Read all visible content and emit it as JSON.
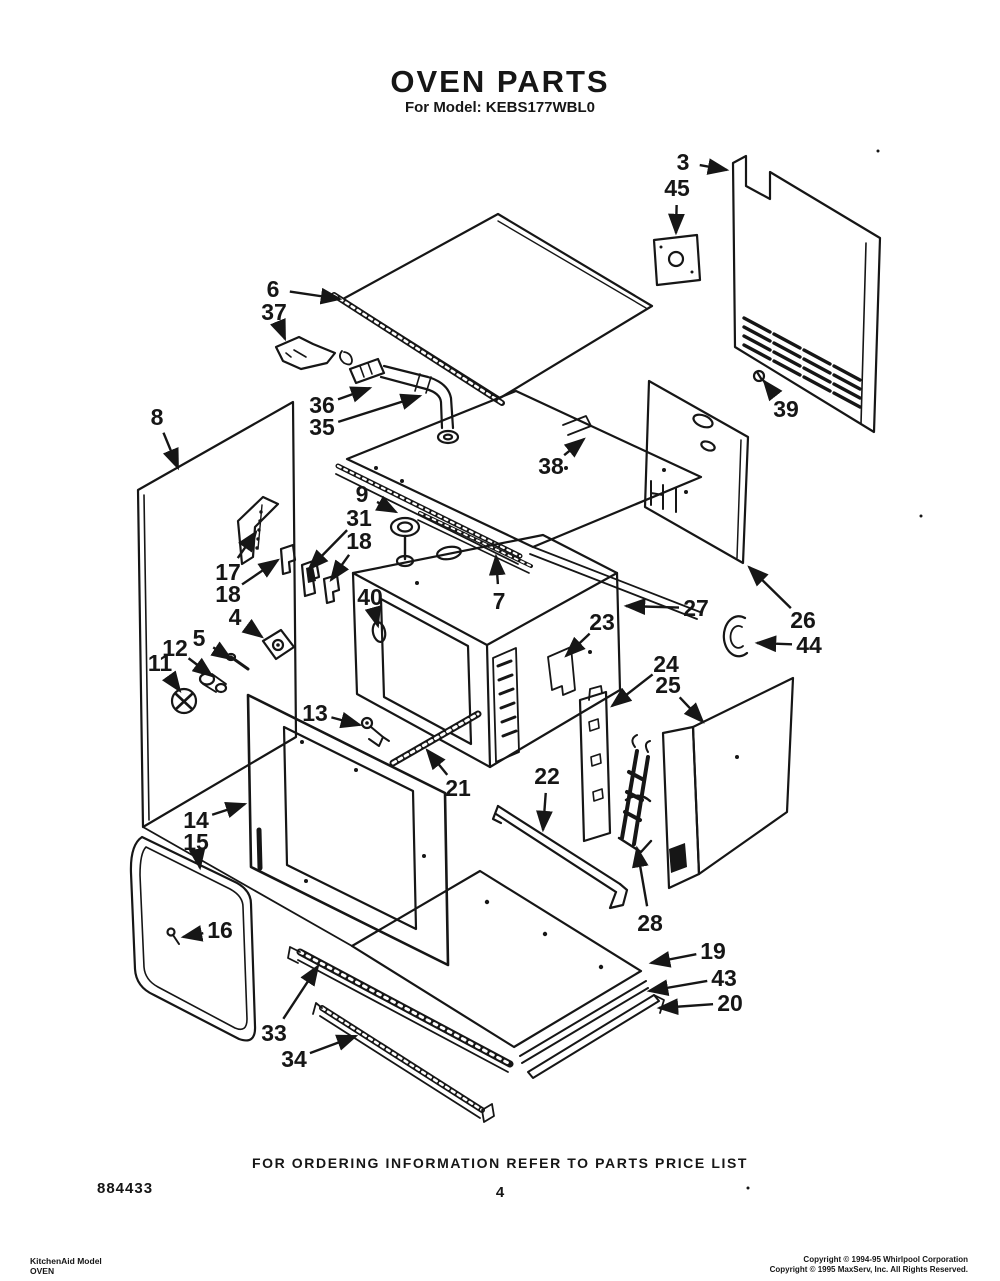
{
  "page": {
    "title": "OVEN PARTS",
    "subtitle": "For Model: KEBS177WBL0",
    "footer": {
      "ordering_note": "FOR ORDERING INFORMATION REFER TO PARTS PRICE LIST",
      "page_number": "4",
      "document_number": "884433",
      "corner_left_line1": "KitchenAid Model",
      "corner_left_line2": "OVEN",
      "copyright_line1": "Copyright © 1994-95 Whirlpool Corporation",
      "copyright_line2": "Copyright © 1995 MaxServ, Inc.  All Rights Reserved."
    }
  },
  "diagram": {
    "kind": "exploded-parts-diagram",
    "ink_color": "#161616",
    "paper_color": "#ffffff",
    "callouts": [
      {
        "num": "3",
        "lx": 683,
        "ly": 162,
        "ax": 727,
        "ay": 170
      },
      {
        "num": "45",
        "lx": 677,
        "ly": 188,
        "ax": 676,
        "ay": 233
      },
      {
        "num": "39",
        "lx": 786,
        "ly": 409,
        "ax": 764,
        "ay": 381
      },
      {
        "num": "6",
        "lx": 273,
        "ly": 289,
        "ax": 340,
        "ay": 299
      },
      {
        "num": "37",
        "lx": 274,
        "ly": 312,
        "ax": 285,
        "ay": 339
      },
      {
        "num": "36",
        "lx": 322,
        "ly": 405,
        "ax": 370,
        "ay": 388
      },
      {
        "num": "35",
        "lx": 322,
        "ly": 427,
        "ax": 420,
        "ay": 396
      },
      {
        "num": "8",
        "lx": 157,
        "ly": 417,
        "ax": 178,
        "ay": 468
      },
      {
        "num": "9",
        "lx": 362,
        "ly": 494,
        "ax": 396,
        "ay": 512
      },
      {
        "num": "31",
        "lx": 359,
        "ly": 518,
        "ax": 309,
        "ay": 569
      },
      {
        "num": "18",
        "lx": 359,
        "ly": 541,
        "ax": 331,
        "ay": 580
      },
      {
        "num": "17",
        "lx": 228,
        "ly": 572,
        "ax": 256,
        "ay": 532
      },
      {
        "num": "18",
        "lx": 228,
        "ly": 594,
        "ax": 278,
        "ay": 560
      },
      {
        "num": "40",
        "lx": 370,
        "ly": 597,
        "ax": 378,
        "ay": 626
      },
      {
        "num": "4",
        "lx": 235,
        "ly": 617,
        "ax": 262,
        "ay": 637
      },
      {
        "num": "5",
        "lx": 199,
        "ly": 638,
        "ax": 231,
        "ay": 659
      },
      {
        "num": "12",
        "lx": 175,
        "ly": 648,
        "ax": 212,
        "ay": 676
      },
      {
        "num": "11",
        "lx": 160,
        "ly": 663,
        "ax": 180,
        "ay": 691
      },
      {
        "num": "38",
        "lx": 551,
        "ly": 466,
        "ax": 584,
        "ay": 439
      },
      {
        "num": "7",
        "lx": 499,
        "ly": 601,
        "ax": 496,
        "ay": 556
      },
      {
        "num": "27",
        "lx": 696,
        "ly": 608,
        "ax": 626,
        "ay": 606
      },
      {
        "num": "26",
        "lx": 803,
        "ly": 620,
        "ax": 749,
        "ay": 567
      },
      {
        "num": "44",
        "lx": 809,
        "ly": 645,
        "ax": 757,
        "ay": 643
      },
      {
        "num": "23",
        "lx": 602,
        "ly": 622,
        "ax": 566,
        "ay": 656
      },
      {
        "num": "24",
        "lx": 666,
        "ly": 664,
        "ax": 612,
        "ay": 706
      },
      {
        "num": "25",
        "lx": 668,
        "ly": 685,
        "ax": 703,
        "ay": 722
      },
      {
        "num": "13",
        "lx": 315,
        "ly": 713,
        "ax": 360,
        "ay": 725
      },
      {
        "num": "21",
        "lx": 458,
        "ly": 788,
        "ax": 427,
        "ay": 750
      },
      {
        "num": "22",
        "lx": 547,
        "ly": 776,
        "ax": 543,
        "ay": 830
      },
      {
        "num": "14",
        "lx": 196,
        "ly": 820,
        "ax": 245,
        "ay": 804
      },
      {
        "num": "15",
        "lx": 196,
        "ly": 842,
        "ax": 200,
        "ay": 868
      },
      {
        "num": "16",
        "lx": 220,
        "ly": 930,
        "ax": 183,
        "ay": 937
      },
      {
        "num": "28",
        "lx": 650,
        "ly": 923,
        "ax": 637,
        "ay": 848
      },
      {
        "num": "19",
        "lx": 713,
        "ly": 951,
        "ax": 651,
        "ay": 963
      },
      {
        "num": "43",
        "lx": 724,
        "ly": 978,
        "ax": 649,
        "ay": 991
      },
      {
        "num": "20",
        "lx": 730,
        "ly": 1003,
        "ax": 659,
        "ay": 1008
      },
      {
        "num": "33",
        "lx": 274,
        "ly": 1033,
        "ax": 318,
        "ay": 966
      },
      {
        "num": "34",
        "lx": 294,
        "ly": 1059,
        "ax": 356,
        "ay": 1036
      }
    ]
  }
}
